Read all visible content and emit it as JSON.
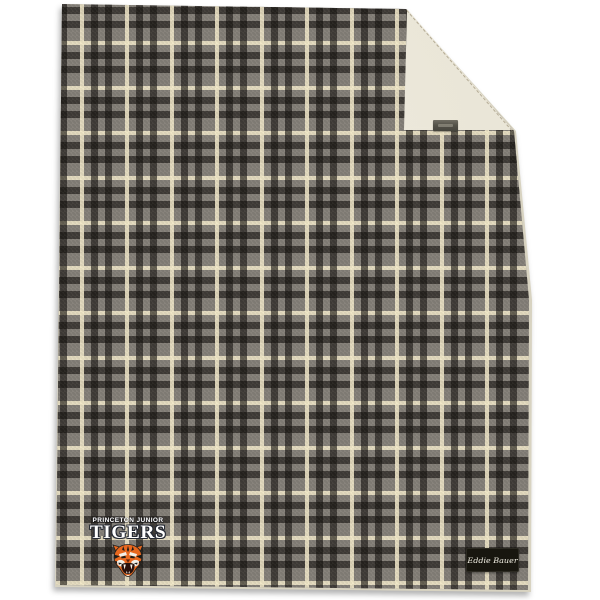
{
  "page": {
    "background_color": "#ffffff",
    "alt": "Gray plaid flannel blanket with cream sherpa lining; top-right corner folded over showing sherpa and a woven tag; embroidered team logo at bottom left; black brand script tag at bottom right"
  },
  "blanket": {
    "plaid": {
      "base_color": "#847f78",
      "dark_band_color": "#2b2722",
      "cream_stripe_color": "#e7dec3",
      "repeat_px": 45
    },
    "sherpa": {
      "color": "#e9e5d6"
    },
    "logo": {
      "line1": "PRINCETON JUNIOR",
      "line2": "TIGERS",
      "mascot": "tiger-head",
      "text_color": "#ffffff",
      "outline_color": "#262a34",
      "orange": "#e8681f"
    },
    "brand_tag": {
      "text": "Eddie Bauer",
      "background_color": "#18160f",
      "text_color": "#f2efe4"
    },
    "sherpa_tag": {
      "background_color": "#55534a"
    }
  }
}
